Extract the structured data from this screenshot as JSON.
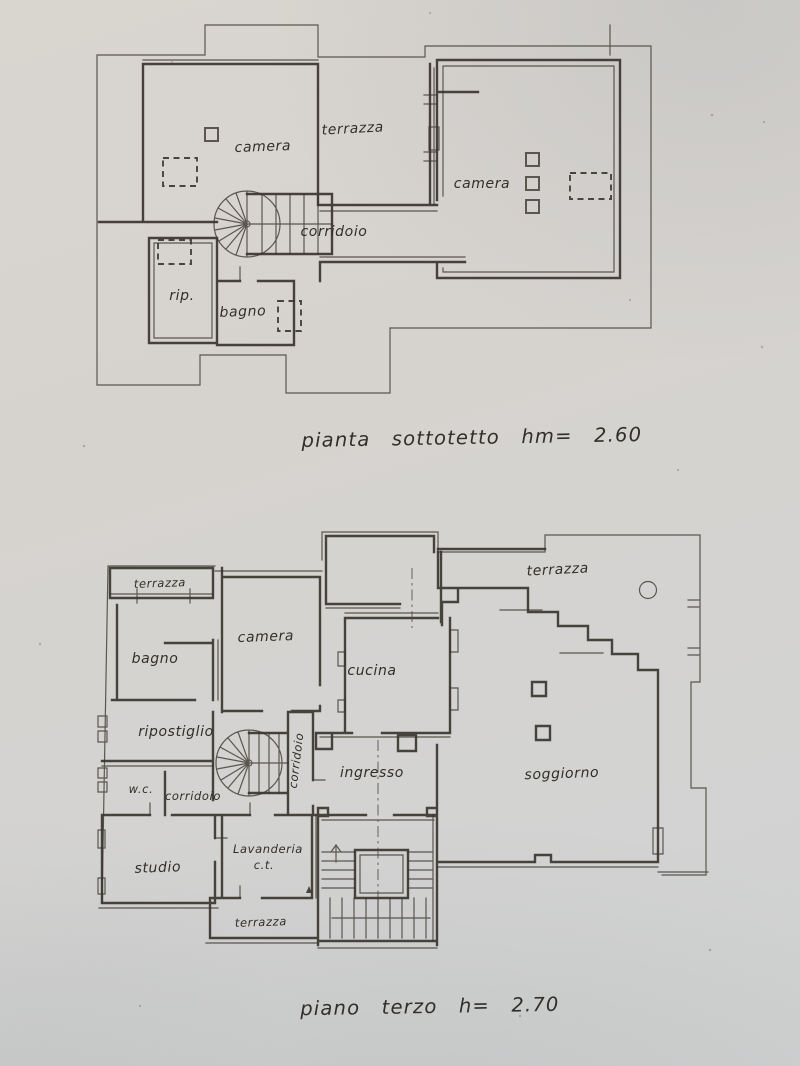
{
  "photo": {
    "paper_color": "#d6d3cf",
    "ink_color": "#39352f"
  },
  "plan_sottotetto": {
    "caption": "pianta sottotetto hm= 2.60",
    "labels": {
      "camera_left": "camera",
      "terrazza": "terrazza",
      "camera_right": "camera",
      "corridoio": "corridoio",
      "ripostiglio": "rip.",
      "bagno": "bagno"
    }
  },
  "plan_piano_terzo": {
    "caption": "piano terzo h= 2.70",
    "labels": {
      "terrazza_top_left": "terrazza",
      "bagno": "bagno",
      "camera": "camera",
      "cucina": "cucina",
      "terrazza_top_right": "terrazza",
      "ripostiglio": "ripostiglio",
      "corridoio_vertical": "corridoio",
      "wc": "w.c.",
      "corridoio": "corridoio",
      "ingresso": "ingresso",
      "soggiorno": "soggiorno",
      "studio": "studio",
      "lavanderia": "Lavanderia",
      "ct": "c.t.",
      "terrazza_bottom": "terrazza"
    }
  }
}
